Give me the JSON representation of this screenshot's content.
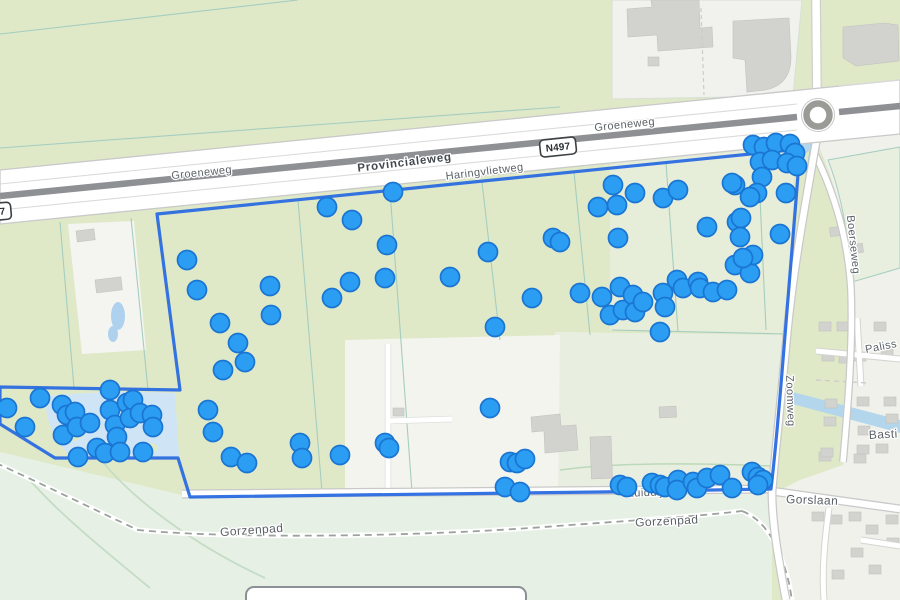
{
  "map": {
    "road_labels": [
      {
        "text": "Groeneweg"
      },
      {
        "text": "Provincialeweg"
      },
      {
        "text": "Haringvlietweg"
      },
      {
        "text": "Groeneweg"
      },
      {
        "text": "Zuiddijk"
      },
      {
        "text": "Gorslaan"
      },
      {
        "text": "Gorzenpad"
      },
      {
        "text": "Gorzenpad"
      },
      {
        "text": "Boerseweg"
      },
      {
        "text": "Zoomweg"
      },
      {
        "text": "Paliss"
      },
      {
        "text": "Basti"
      }
    ],
    "route_shields": [
      {
        "text": "N497"
      },
      {
        "text": "N497"
      }
    ],
    "colors": {
      "field_green": "#dfe9c8",
      "field_pale": "#e9efe0",
      "clearing": "#f3f4ee",
      "residential": "#eff1ea",
      "bottom_area": "#e6f0e5",
      "water": "#b3d6ec",
      "water_light": "#cfe5f6",
      "road_white": "#ffffff",
      "road_casing": "#c9c9c9",
      "highway_median": "#8f9094",
      "building_gray": "#d2d2cf",
      "parcel_line": "#a5cdc0",
      "label_gray": "#5b6267",
      "boundary_blue": "#2a6ce2",
      "marker_fill": "#2b9df3",
      "marker_stroke": "#1a75d2"
    },
    "marker_style": {
      "radius": 9.5,
      "fill": "#2b9df3",
      "stroke": "#1a75d2",
      "stroke_width": 1.7
    },
    "markers": [
      [
        327,
        207
      ],
      [
        352,
        220
      ],
      [
        393,
        192
      ],
      [
        187,
        260
      ],
      [
        197,
        290
      ],
      [
        270,
        286
      ],
      [
        271,
        315
      ],
      [
        332,
        298
      ],
      [
        350,
        282
      ],
      [
        387,
        245
      ],
      [
        385,
        278
      ],
      [
        220,
        323
      ],
      [
        238,
        343
      ],
      [
        245,
        362
      ],
      [
        223,
        370
      ],
      [
        208,
        410
      ],
      [
        213,
        432
      ],
      [
        231,
        457
      ],
      [
        247,
        463
      ],
      [
        300,
        443
      ],
      [
        302,
        458
      ],
      [
        340,
        455
      ],
      [
        385,
        443
      ],
      [
        389,
        448
      ],
      [
        613,
        185
      ],
      [
        635,
        193
      ],
      [
        598,
        207
      ],
      [
        617,
        205
      ],
      [
        663,
        198
      ],
      [
        678,
        190
      ],
      [
        618,
        238
      ],
      [
        707,
        227
      ],
      [
        735,
        185
      ],
      [
        553,
        238
      ],
      [
        560,
        242
      ],
      [
        488,
        252
      ],
      [
        450,
        277
      ],
      [
        532,
        298
      ],
      [
        495,
        327
      ],
      [
        580,
        293
      ],
      [
        602,
        297
      ],
      [
        610,
        315
      ],
      [
        620,
        287
      ],
      [
        623,
        310
      ],
      [
        633,
        295
      ],
      [
        635,
        312
      ],
      [
        643,
        302
      ],
      [
        663,
        293
      ],
      [
        665,
        307
      ],
      [
        677,
        280
      ],
      [
        683,
        288
      ],
      [
        698,
        282
      ],
      [
        700,
        288
      ],
      [
        713,
        292
      ],
      [
        727,
        290
      ],
      [
        735,
        265
      ],
      [
        750,
        273
      ],
      [
        753,
        255
      ],
      [
        660,
        332
      ],
      [
        737,
        222
      ],
      [
        740,
        237
      ],
      [
        743,
        258
      ],
      [
        753,
        145
      ],
      [
        764,
        147
      ],
      [
        776,
        143
      ],
      [
        790,
        144
      ],
      [
        795,
        153
      ],
      [
        760,
        162
      ],
      [
        772,
        160
      ],
      [
        787,
        163
      ],
      [
        797,
        166
      ],
      [
        762,
        177
      ],
      [
        732,
        183
      ],
      [
        757,
        193
      ],
      [
        786,
        193
      ],
      [
        750,
        197
      ],
      [
        741,
        218
      ],
      [
        780,
        234
      ],
      [
        490,
        408
      ],
      [
        510,
        462
      ],
      [
        517,
        463
      ],
      [
        525,
        459
      ],
      [
        505,
        487
      ],
      [
        520,
        492
      ],
      [
        620,
        485
      ],
      [
        627,
        487
      ],
      [
        652,
        483
      ],
      [
        660,
        485
      ],
      [
        665,
        487
      ],
      [
        678,
        480
      ],
      [
        677,
        490
      ],
      [
        693,
        482
      ],
      [
        697,
        488
      ],
      [
        707,
        478
      ],
      [
        720,
        475
      ],
      [
        732,
        488
      ],
      [
        752,
        472
      ],
      [
        758,
        477
      ],
      [
        763,
        480
      ],
      [
        758,
        485
      ],
      [
        7,
        408
      ],
      [
        25,
        427
      ],
      [
        40,
        398
      ],
      [
        62,
        405
      ],
      [
        67,
        415
      ],
      [
        75,
        412
      ],
      [
        63,
        435
      ],
      [
        77,
        427
      ],
      [
        78,
        457
      ],
      [
        90,
        423
      ],
      [
        97,
        448
      ],
      [
        105,
        453
      ],
      [
        110,
        410
      ],
      [
        115,
        425
      ],
      [
        117,
        437
      ],
      [
        127,
        403
      ],
      [
        130,
        418
      ],
      [
        133,
        400
      ],
      [
        140,
        413
      ],
      [
        152,
        415
      ],
      [
        153,
        427
      ],
      [
        143,
        452
      ],
      [
        120,
        452
      ],
      [
        110,
        390
      ]
    ]
  }
}
